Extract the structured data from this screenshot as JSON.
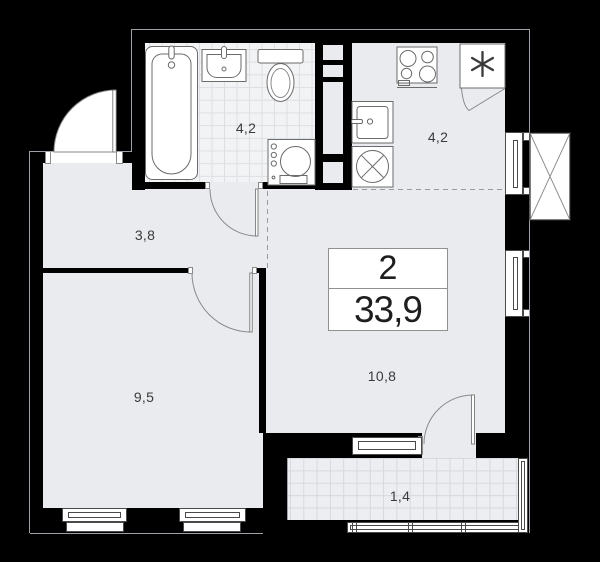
{
  "plan": {
    "info_card": {
      "rooms_count": "2",
      "total_area": "33,9"
    },
    "rooms": {
      "bathroom": {
        "area": "4,2"
      },
      "kitchen": {
        "area": "4,2"
      },
      "hallway": {
        "area": "3,8"
      },
      "bedroom": {
        "area": "9,5"
      },
      "living_room": {
        "area": "10,8"
      },
      "balcony": {
        "area": "1,4"
      }
    },
    "fixtures": [
      "bathtub",
      "bathroom-sink",
      "toilet",
      "washing-machine",
      "kitchen-sink",
      "kitchen-washer",
      "stove",
      "fridge",
      "vent-shaft"
    ],
    "icons": {
      "fridge": "snowflake-asterisk",
      "kitchen_washer": "circle-cross",
      "vent_shaft": "crossed-box"
    },
    "colors": {
      "background": "#000000",
      "floor": "#e9ebee",
      "bathroom_tile": "#f2f3f5",
      "balcony_tile": "#eceef1",
      "fixture_stroke": "#6b6b6b",
      "outline": "#9ba1a7",
      "text": "#3a3a3a"
    }
  }
}
